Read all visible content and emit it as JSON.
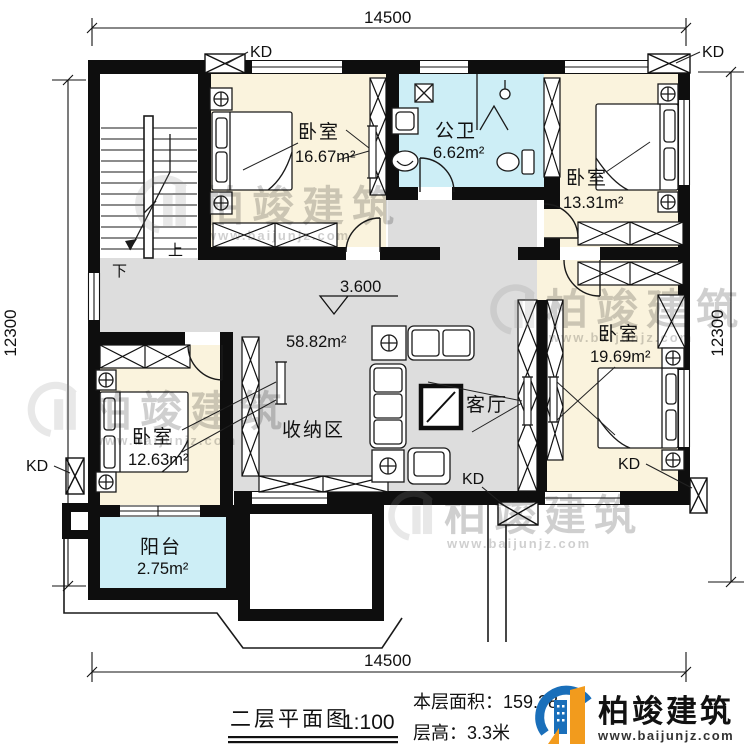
{
  "plan": {
    "kd": "KD",
    "level_mark": "3.600",
    "stairs": {
      "up": "上",
      "down": "下"
    },
    "rooms": {
      "bedroom1": {
        "name": "卧室",
        "area": "16.67m²"
      },
      "bathroom": {
        "name": "公卫",
        "area": "6.62m²"
      },
      "bedroom2": {
        "name": "卧室",
        "area": "13.31m²"
      },
      "bedroom3": {
        "name": "卧室",
        "area": "19.69m²"
      },
      "living": {
        "name": "客厅",
        "area": "58.82m²"
      },
      "storage": {
        "name": "收纳区"
      },
      "bedroom4": {
        "name": "卧室",
        "area": "12.63m²"
      },
      "balcony": {
        "name": "阳台",
        "area": "2.75m²"
      }
    }
  },
  "dimensions": {
    "top": "14500",
    "bottom": "14500",
    "left": "12300",
    "right": "12300"
  },
  "titleblock": {
    "title": "二层平面图",
    "scale": "1:100",
    "area_label": "本层面积：159.38",
    "height_label": "层高：3.3米"
  },
  "logo": {
    "name": "柏竣建筑",
    "url": "www.baijunjz.com"
  },
  "watermark": {
    "name": "柏竣建筑",
    "url": "www.baijunjz.com"
  },
  "colors": {
    "wall": "#0e0e0e",
    "bedroom_floor": "#faf3dd",
    "wet_floor": "#cdeef6",
    "hall_floor": "#dddddd",
    "logo_blue": "#1a6fba",
    "logo_orange": "#f29b1d"
  }
}
